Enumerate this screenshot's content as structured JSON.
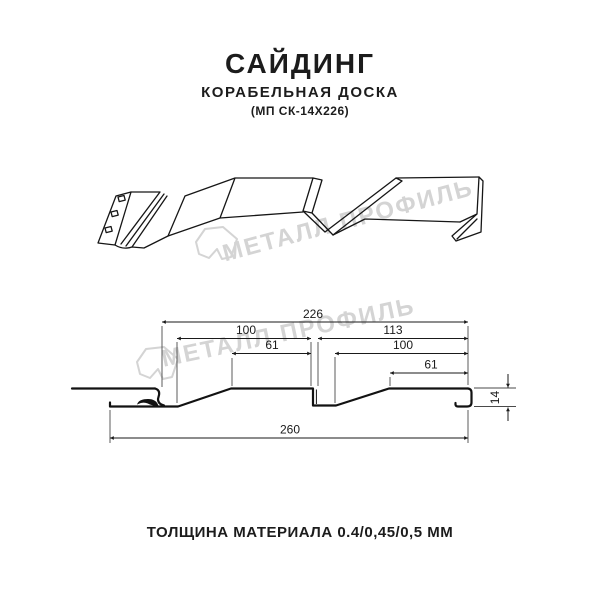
{
  "header": {
    "title": "САЙДИНГ",
    "subtitle": "КОРАБЕЛЬНАЯ ДОСКА",
    "code": "(МП СК-14Х226)"
  },
  "footer": {
    "text": "ТОЛЩИНА МАТЕРИАЛА 0.4/0,45/0,5 ММ"
  },
  "watermark": {
    "text": "МЕТАЛЛ ПРОФИЛЬ",
    "color": "#d4d4d4"
  },
  "drawing": {
    "type": "profile-technical-drawing",
    "views": [
      "3d-perspective-view",
      "cross-section-with-dimensions"
    ],
    "units": "mm"
  },
  "dims": {
    "d226": "226",
    "d100_left": "100",
    "d61_left": "61",
    "d113": "113",
    "d100_right": "100",
    "d61_right": "61",
    "d14": "14",
    "d260": "260"
  },
  "colors": {
    "line": "#161616",
    "text": "#1c1c1c",
    "watermark": "#d4d4d4",
    "background": "#ffffff"
  }
}
